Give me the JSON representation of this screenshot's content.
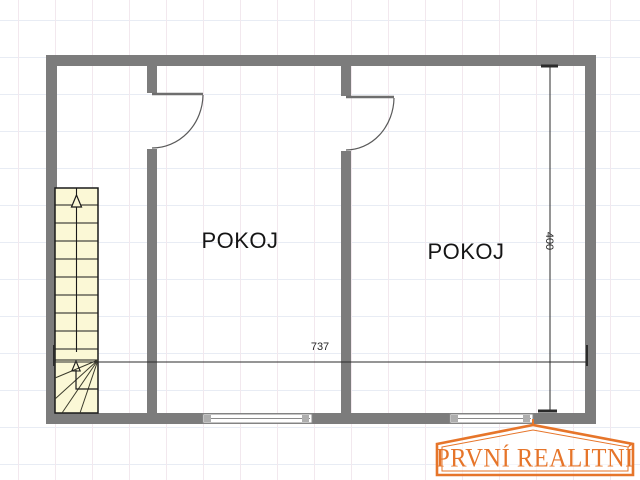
{
  "floorplan": {
    "room1": {
      "label": "POKOJ"
    },
    "room2": {
      "label": "POKOJ"
    },
    "dim_width": "737",
    "dim_height": "400"
  },
  "watermark": {
    "text": "PRVNÍ REALITNÍ"
  },
  "colors": {
    "wall": "#7c7c7c",
    "stair": "#fbf8d6",
    "accent": "#e6752a",
    "grid-v": "#f2e8ee",
    "grid-h": "#e8ecf4",
    "line": "#2b2b2b"
  }
}
